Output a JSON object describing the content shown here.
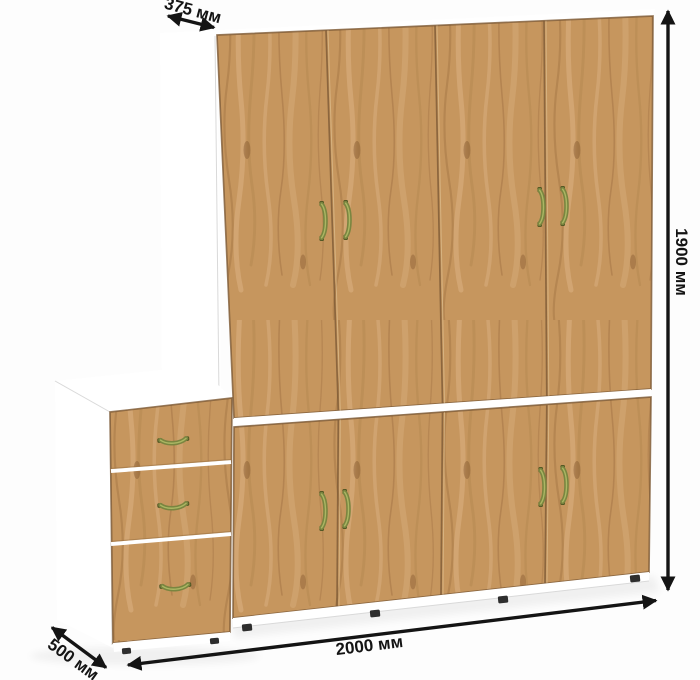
{
  "scene": {
    "type": "furniture-dimension-diagram",
    "item": "wardrobe with four upper doors, four lower doors and a three-drawer side cabinet",
    "wardrobe_top_doors": 4,
    "wardrobe_bottom_doors": 4,
    "drawer_count": 3,
    "handle_style": "antique brass bow handles"
  },
  "dimensions": {
    "top_depth": "375 мм",
    "height": "1900 мм",
    "width": "2000 мм",
    "side_depth": "500 мм"
  },
  "colors": {
    "background": "#fdfdfd",
    "carcass_white": "#ffffff",
    "carcass_shade": "#ececec",
    "wood_base": "#c6965e",
    "wood_dark": "#a87847",
    "wood_mid": "#b78a52",
    "wood_light": "#ddb486",
    "wood_knot": "#8a5e33",
    "seam": "#7d5a36",
    "handle": "#7a8540",
    "handle_dark": "#4f5522",
    "handle_light": "#b3c06a",
    "dimension_ink": "#141414",
    "foot": "#2e2e2e"
  }
}
